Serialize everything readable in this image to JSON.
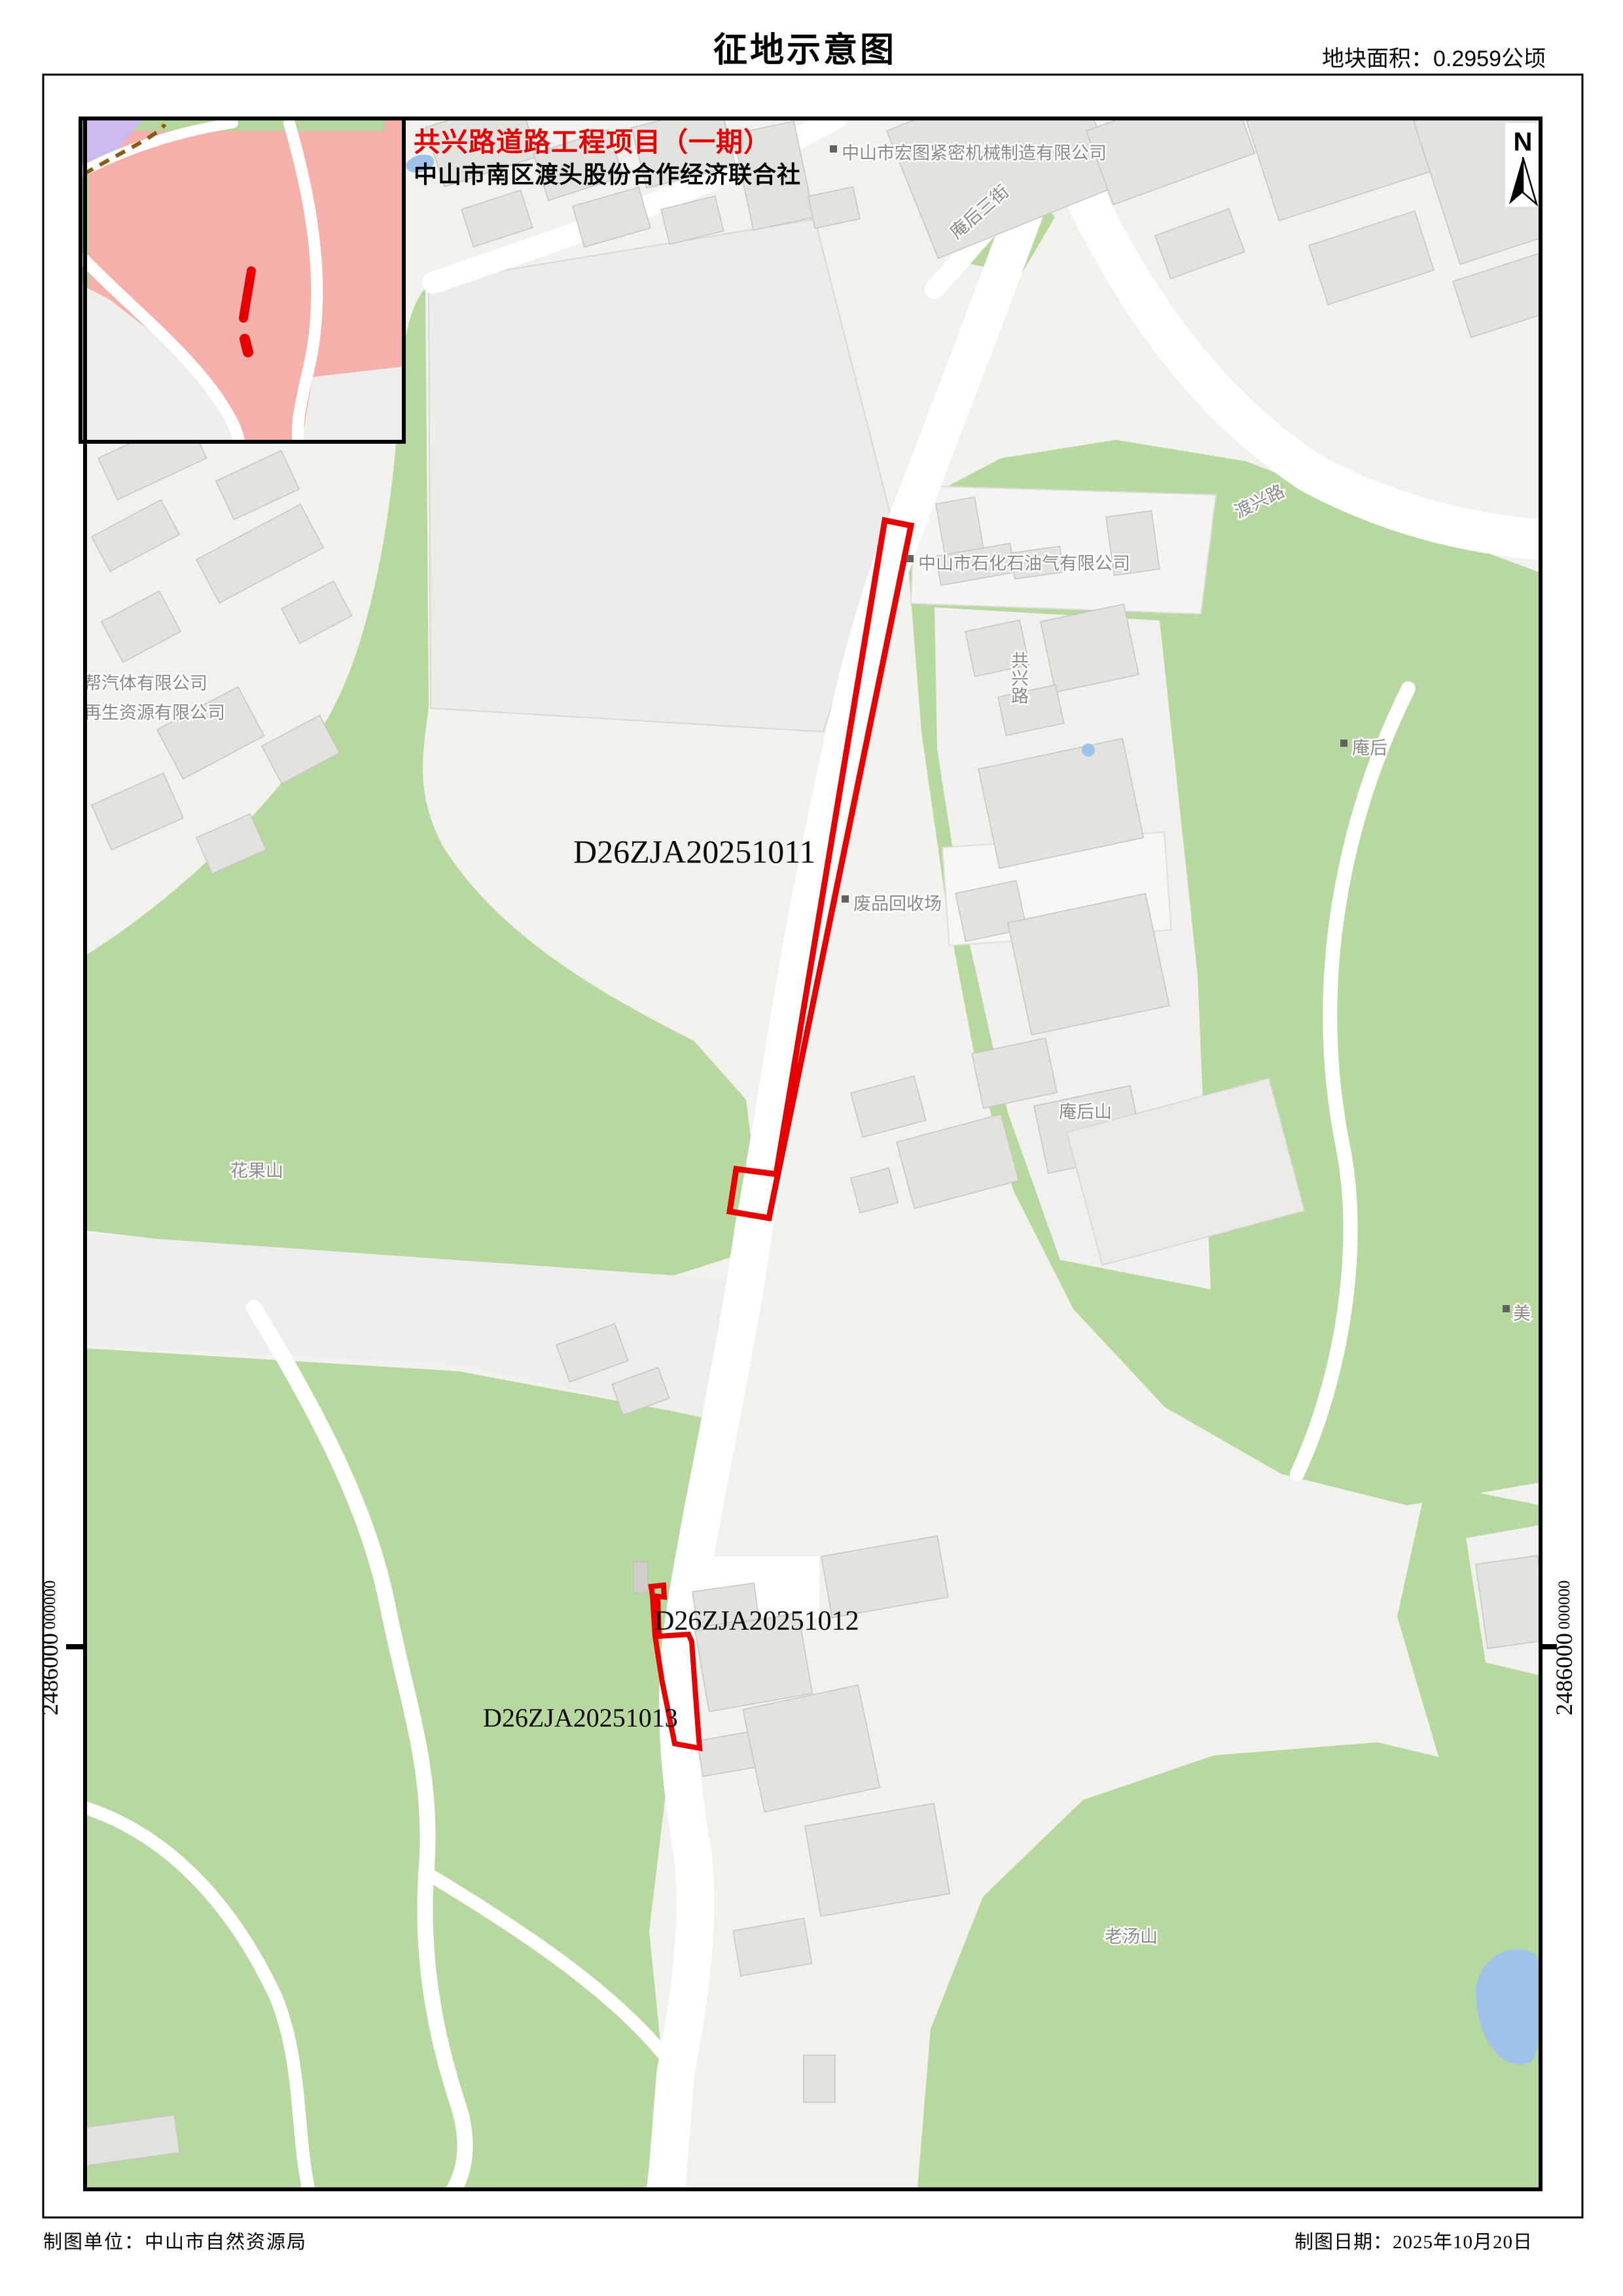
{
  "header": {
    "title": "征地示意图",
    "area_label": "地块面积：0.2959公顷"
  },
  "legend": {
    "project_title": "共兴路道路工程项目（一期）",
    "organization": "中山市南区渡头股份合作经济联合社"
  },
  "parcels": {
    "p1": "D26ZJA20251011",
    "p2": "D26ZJA20251012",
    "p3": "D26ZJA20251013"
  },
  "map_labels": {
    "company_hongtu": "中山市宏图紧密机械制造有限公司",
    "street_anhou3": "庵后三街",
    "road_duxing": "渡兴路",
    "company_shihua": "中山市石化石油气有限公司",
    "village_anhou": "庵后",
    "site_feipin": "废品回收场",
    "hill_anhoushan": "庵后山",
    "hill_huaguoshan": "花果山",
    "company_bangqiti": "帮汽体有限公司",
    "company_zaisheng": "再生资源有限公司",
    "village_mei": "美",
    "hill_laotangshan": "老汤山",
    "road_gongxing": "共兴路"
  },
  "grid": {
    "northing": "2486000",
    "ghost": "000000"
  },
  "compass": {
    "north": "N"
  },
  "footer": {
    "producer": "制图单位：中山市自然资源局",
    "date": "制图日期：2025年10月20日"
  },
  "colors": {
    "parcel": "#e60000",
    "title_red": "#e60000",
    "green": "#b7d89f",
    "water": "#9fc3e8",
    "inset_pink": "#f6b0ac",
    "inset_purple": "#ccbaef"
  }
}
